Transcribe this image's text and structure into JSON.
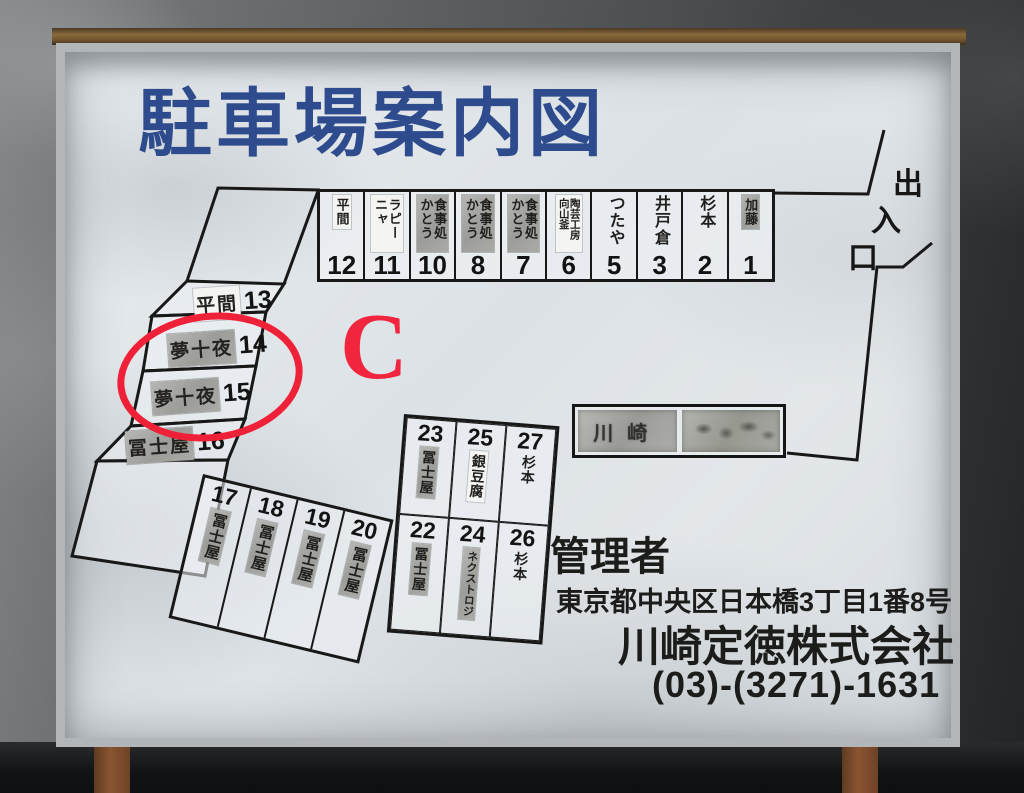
{
  "title": "駐車場案内図",
  "entrance": {
    "chars": [
      "出",
      "入",
      "口"
    ]
  },
  "annotation": {
    "letter": "C",
    "color": "#f1263e",
    "circled_spots": [
      "14",
      "15"
    ]
  },
  "manager": {
    "heading": "管理者",
    "address": "東京都中央区日本橋3丁目1番8号",
    "company": "川崎定徳株式会社",
    "phone": "(03)-(3271)-1631"
  },
  "kawasaki_box": {
    "plates": [
      {
        "text": "川崎",
        "legible": true
      },
      {
        "text": "",
        "legible": false
      }
    ]
  },
  "colors": {
    "title_navy": "#2e4c8d",
    "line_black": "#181818",
    "annotation_red": "#ef2138",
    "patch_silver": "#a8a9a4",
    "board_white": "#e3e7ea"
  },
  "spots": {
    "top_row": [
      {
        "num": "12",
        "name": "平間",
        "patch": "paper"
      },
      {
        "num": "11",
        "name": "ラピーニャ",
        "patch": "paper"
      },
      {
        "num": "10",
        "name": "食事処かとう",
        "patch": "silver"
      },
      {
        "num": "8",
        "name": "食事処かとう",
        "patch": "silver"
      },
      {
        "num": "7",
        "name": "食事処かとう",
        "patch": "silver"
      },
      {
        "num": "6",
        "name": "陶芸工房向山釜",
        "patch": "paper"
      },
      {
        "num": "5",
        "name": "つたや",
        "patch": "none"
      },
      {
        "num": "3",
        "name": "井戸倉",
        "patch": "none"
      },
      {
        "num": "2",
        "name": "杉本",
        "patch": "none"
      },
      {
        "num": "1",
        "name": "加藤",
        "patch": "silver"
      }
    ],
    "left_column": [
      {
        "num": "13",
        "name": "平間",
        "patch": "paper"
      },
      {
        "num": "14",
        "name": "夢十夜",
        "patch": "silver"
      },
      {
        "num": "15",
        "name": "夢十夜",
        "patch": "silver"
      },
      {
        "num": "16",
        "name": "冨士屋",
        "patch": "silver"
      }
    ],
    "bottom_row": [
      {
        "num": "17",
        "name": "冨士屋",
        "patch": "silver"
      },
      {
        "num": "18",
        "name": "冨士屋",
        "patch": "silver"
      },
      {
        "num": "19",
        "name": "冨士屋",
        "patch": "silver"
      },
      {
        "num": "20",
        "name": "冨士屋",
        "patch": "silver"
      }
    ],
    "block_top": [
      {
        "num": "23",
        "name": "冨士屋",
        "patch": "silver"
      },
      {
        "num": "25",
        "name": "銀豆腐",
        "patch": "paper"
      },
      {
        "num": "27",
        "name": "杉本",
        "patch": "none"
      }
    ],
    "block_bottom": [
      {
        "num": "22",
        "name": "冨士屋",
        "patch": "silver"
      },
      {
        "num": "24",
        "name": "ネクストロジ",
        "patch": "silver"
      },
      {
        "num": "26",
        "name": "杉本",
        "patch": "none"
      }
    ]
  }
}
